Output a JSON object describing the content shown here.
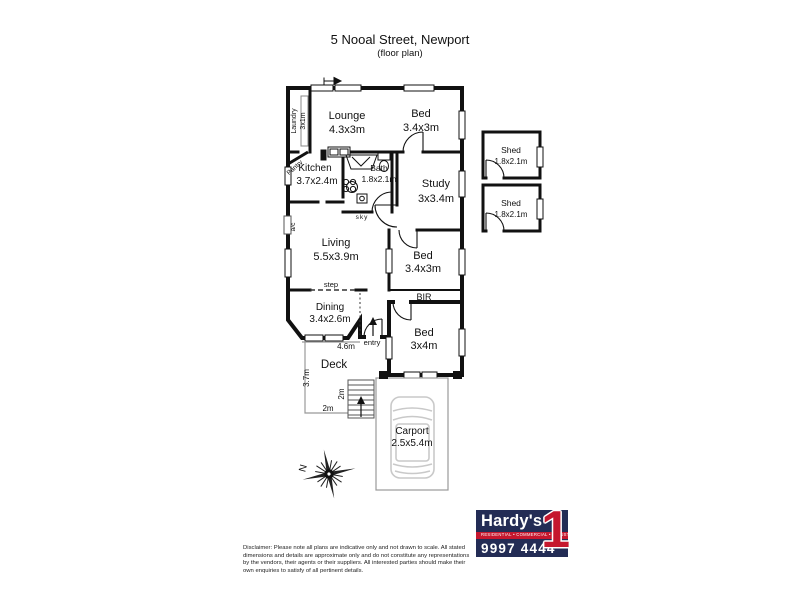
{
  "header": {
    "address": "5 Nooal Street, Newport",
    "subtitle": "(floor plan)"
  },
  "rooms": {
    "lounge": {
      "name": "Lounge",
      "dims": "4.3x3m"
    },
    "bed_top": {
      "name": "Bed",
      "dims": "3.4x3m"
    },
    "laundry": {
      "name": "Laundry",
      "dims": "3x1m"
    },
    "pantry": {
      "name": "Pantry"
    },
    "kitchen": {
      "name": "Kitchen",
      "dims": "3.7x2.4m"
    },
    "bath": {
      "name": "Bath",
      "dims": "1.8x2.1m"
    },
    "study": {
      "name": "Study",
      "dims": "3x3.4m"
    },
    "living": {
      "name": "Living",
      "dims": "5.5x3.9m"
    },
    "bed_middle": {
      "name": "Bed",
      "dims": "3.4x3m"
    },
    "dining": {
      "name": "Dining",
      "dims": "3.4x2.6m"
    },
    "bed_bottom": {
      "name": "Bed",
      "dims": "3x4m"
    },
    "deck": {
      "name": "Deck"
    },
    "carport": {
      "name": "Carport",
      "dims": "2.5x5.4m"
    },
    "shed_upper": {
      "name": "Shed",
      "dims": "1.8x2.1m"
    },
    "shed_lower": {
      "name": "Shed",
      "dims": "1.8x2.1m"
    }
  },
  "annotations": {
    "built_in_robe": "BIR",
    "step": "step",
    "entry": "entry",
    "skylight": "sky",
    "air_conditioner": "a/c",
    "deck_width": "4.6m",
    "deck_length": "3.7m",
    "stair_length": "2m",
    "deck_bottom_width": "2m",
    "north": "N"
  },
  "agency": {
    "brand": "Hardy's",
    "numeral": "1",
    "tagline": "RESIDENTIAL • COMMERCIAL • INDUSTRIAL",
    "phone": "9997 4444",
    "navy": "#232C55",
    "red": "#C5172E"
  },
  "footer": {
    "disclaimer": "Disclaimer: Please note all plans are indicative only and not drawn to scale. All stated dimensions and details are approximate only and do not constitute any representations by the vendors, their agents or their suppliers. All interested parties should make their own enquiries to satisfy of all pertinent details."
  }
}
